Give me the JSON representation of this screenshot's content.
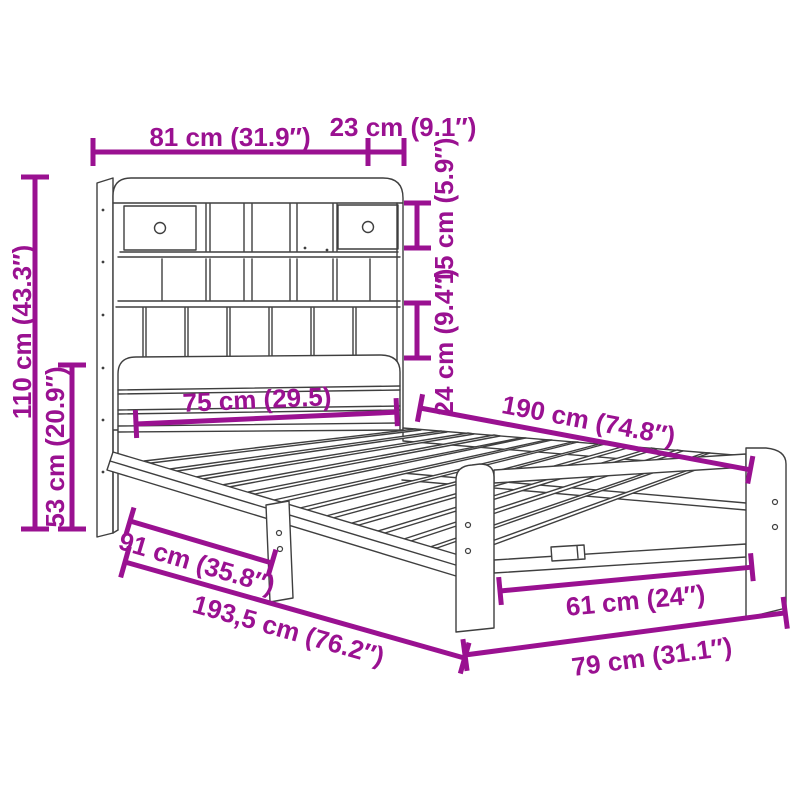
{
  "diagram": {
    "type": "product-dimension-diagram",
    "subject": "bed-frame-with-bookcase-headboard",
    "colors": {
      "dimension_color": "#9a1191",
      "drawing_line_color": "#3f3f3f",
      "background": "#ffffff"
    },
    "dimensions": [
      {
        "id": "headboard-width",
        "label": "81 cm (31.9″)"
      },
      {
        "id": "shelf-depth",
        "label": "23 cm (9.1″)"
      },
      {
        "id": "headboard-height",
        "label": "110 cm (43.3″)"
      },
      {
        "id": "lower-headboard-height",
        "label": "53 cm (20.9″)"
      },
      {
        "id": "upper-shelf-height",
        "label": "15 cm (5.9″)"
      },
      {
        "id": "lower-shelf-height",
        "label": "24 cm (9.4″)"
      },
      {
        "id": "headboard-inner-width",
        "label": "75 cm (29.5)"
      },
      {
        "id": "bed-length",
        "label": "190 cm (74.8″)"
      },
      {
        "id": "side-rail-length",
        "label": "91 cm (35.8″)"
      },
      {
        "id": "total-length",
        "label": "193,5 cm (76.2″)"
      },
      {
        "id": "foot-inner-width",
        "label": "61 cm (24″)"
      },
      {
        "id": "total-width",
        "label": "79 cm (31.1″)"
      }
    ]
  }
}
